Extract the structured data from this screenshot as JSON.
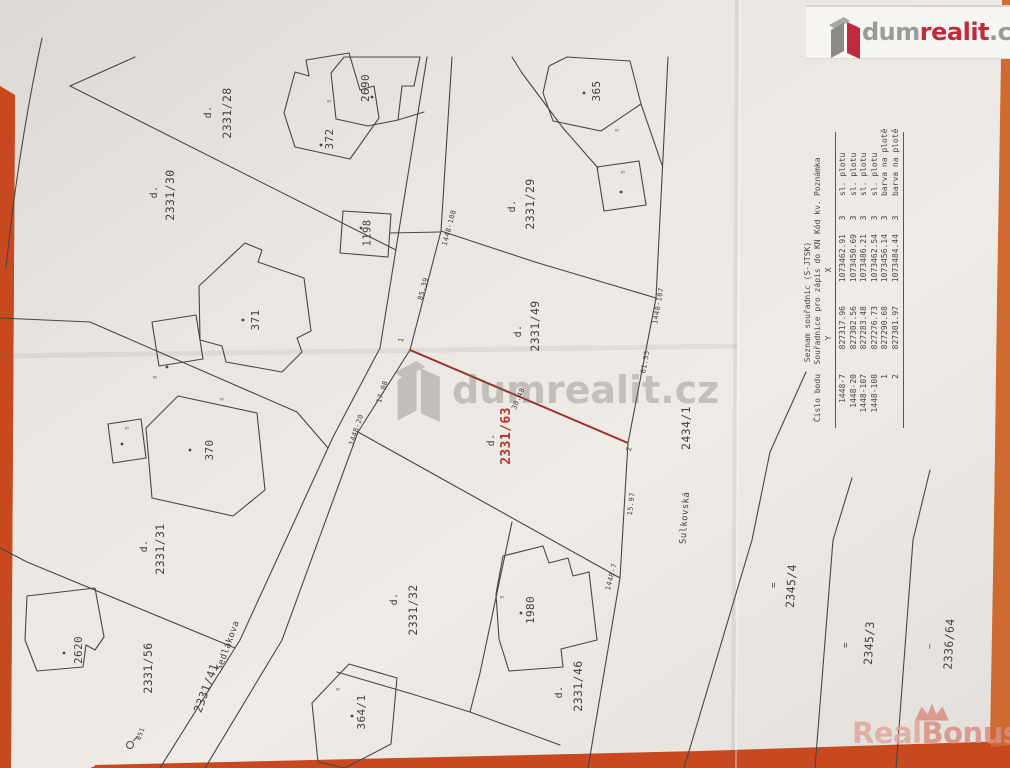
{
  "branding": {
    "logo": {
      "icon": "dumrealit-cube-icon",
      "text_dum": "dum",
      "text_realit": "realit",
      "text_cz": ".cz"
    },
    "watermark_center": {
      "icon": "dumrealit-cube-icon",
      "text": "dumrealit.cz"
    },
    "watermark_bottom": {
      "icon": "crown-icon",
      "text_real": "Real",
      "text_bonus": "Bonus",
      "text_cz": ".cz"
    }
  },
  "colors": {
    "background_red": "#c44a20",
    "paper": "#e9e5e1",
    "ink": "#4a463f",
    "highlight_red": "#9c312a",
    "parcel_red": "#b8352b",
    "tick_gray": "#6b665f",
    "logo_red": "#bf2b3c",
    "logo_gray": "#9a9a9a",
    "watermark_gray": "#8a8580",
    "bonus_pink": "#dc9c92"
  },
  "table": {
    "title": "Seznam souřadnic (S-JTSK)",
    "subtitle": "Souřadnice pro zápis do KN",
    "columns": [
      "Číslo bodu",
      "Y",
      "X",
      "Kód kv.",
      "Poznámka"
    ],
    "rows": [
      [
        "1448-7",
        "827317.96",
        "1073462.91",
        "3",
        "sl. plotu"
      ],
      [
        "1448-20",
        "827302.56",
        "1073450.69",
        "3",
        "sl. plotu"
      ],
      [
        "1448-107",
        "827283.48",
        "1073486.21",
        "3",
        "sl. plotu"
      ],
      [
        "1448-108",
        "827276.73",
        "1073462.54",
        "3",
        "sl. plotu"
      ],
      [
        "1",
        "827290.68",
        "1073456.14",
        "3",
        "barva na plotě"
      ],
      [
        "2",
        "827301.97",
        "1073484.44",
        "3",
        "barva na plotě"
      ]
    ]
  },
  "map": {
    "labels": [
      {
        "t": "d.",
        "x": 209,
        "y": 112,
        "s": 10
      },
      {
        "t": "2331/28",
        "x": 227,
        "y": 113
      },
      {
        "t": "d.",
        "x": 155,
        "y": 192,
        "s": 10
      },
      {
        "t": "2331/30",
        "x": 170,
        "y": 195
      },
      {
        "t": "d.",
        "x": 513,
        "y": 206,
        "s": 10
      },
      {
        "t": "2331/29",
        "x": 530,
        "y": 204
      },
      {
        "t": "d.",
        "x": 519,
        "y": 331,
        "s": 10
      },
      {
        "t": "2331/49",
        "x": 535,
        "y": 326
      },
      {
        "t": "d.",
        "x": 492,
        "y": 440,
        "s": 10
      },
      {
        "t": "2331/63",
        "x": 507,
        "y": 436,
        "s": 13,
        "c": "parcel_red",
        "b": true
      },
      {
        "t": "d.",
        "x": 145,
        "y": 546,
        "s": 10
      },
      {
        "t": "2331/31",
        "x": 160,
        "y": 549
      },
      {
        "t": "2331/56",
        "x": 148,
        "y": 668
      },
      {
        "t": "2331/41",
        "x": 206,
        "y": 688,
        "r": -70
      },
      {
        "t": "Sedlákova",
        "x": 229,
        "y": 646,
        "r": -70,
        "s": 9,
        "n": "street-name-label"
      },
      {
        "t": "d.",
        "x": 395,
        "y": 599,
        "s": 10
      },
      {
        "t": "2331/32",
        "x": 413,
        "y": 610
      },
      {
        "t": "d.",
        "x": 560,
        "y": 692,
        "s": 10
      },
      {
        "t": "2331/46",
        "x": 578,
        "y": 686
      },
      {
        "t": "2434/1",
        "x": 686,
        "y": 428
      },
      {
        "t": "Sulkovská",
        "x": 686,
        "y": 518,
        "r": -86,
        "s": 9,
        "n": "street-name-label"
      },
      {
        "t": "2345/4",
        "x": 791,
        "y": 586,
        "r": -87
      },
      {
        "t": "=",
        "x": 775,
        "y": 585,
        "r": -87,
        "s": 9
      },
      {
        "t": "2345/3",
        "x": 869,
        "y": 643,
        "r": -87
      },
      {
        "t": "=",
        "x": 847,
        "y": 645,
        "r": -87,
        "s": 9
      },
      {
        "t": "2336/64",
        "x": 949,
        "y": 644,
        "r": -87
      },
      {
        "t": "—",
        "x": 931,
        "y": 646,
        "r": -87,
        "s": 9
      },
      {
        "t": "2690",
        "x": 366,
        "y": 88,
        "s": 11,
        "n": "building-number-label"
      },
      {
        "t": "372",
        "x": 330,
        "y": 139,
        "s": 11,
        "n": "building-number-label"
      },
      {
        "t": "1198",
        "x": 368,
        "y": 233,
        "s": 10.5,
        "n": "building-number-label"
      },
      {
        "t": "371",
        "x": 256,
        "y": 320,
        "s": 11,
        "n": "building-number-label"
      },
      {
        "t": "370",
        "x": 210,
        "y": 450,
        "s": 11,
        "n": "building-number-label"
      },
      {
        "t": "2620",
        "x": 79,
        "y": 650,
        "s": 11,
        "n": "building-number-label"
      },
      {
        "t": "364/1",
        "x": 362,
        "y": 712,
        "s": 11,
        "n": "building-number-label"
      },
      {
        "t": "1980",
        "x": 531,
        "y": 610,
        "s": 11,
        "n": "building-number-label"
      },
      {
        "t": "365",
        "x": 597,
        "y": 91,
        "s": 11,
        "n": "building-number-label"
      },
      {
        "t": "1448-108",
        "x": 450,
        "y": 228,
        "s": 7,
        "r": -75,
        "n": "survey-point-label"
      },
      {
        "t": "85.39",
        "x": 424,
        "y": 289,
        "s": 7,
        "r": -75,
        "n": "measurement-label"
      },
      {
        "t": "1",
        "x": 402,
        "y": 340,
        "s": 7,
        "r": -75,
        "n": "survey-point-label"
      },
      {
        "t": "17.08",
        "x": 383,
        "y": 392,
        "s": 7,
        "r": -72,
        "n": "measurement-label"
      },
      {
        "t": "1448-20",
        "x": 357,
        "y": 430,
        "s": 7,
        "r": -72,
        "n": "survey-point-label"
      },
      {
        "t": "30.48",
        "x": 519,
        "y": 399,
        "s": 7,
        "r": -67,
        "n": "measurement-label"
      },
      {
        "t": "2",
        "x": 630,
        "y": 449,
        "s": 7,
        "r": -80,
        "n": "survey-point-label"
      },
      {
        "t": "1448-107",
        "x": 659,
        "y": 306,
        "s": 7,
        "r": -80,
        "n": "survey-point-label"
      },
      {
        "t": "61.55",
        "x": 646,
        "y": 362,
        "s": 7,
        "r": -80,
        "n": "measurement-label"
      },
      {
        "t": "15.97",
        "x": 632,
        "y": 504,
        "s": 7,
        "r": -83,
        "n": "measurement-label"
      },
      {
        "t": "1448-7",
        "x": 612,
        "y": 577,
        "s": 7,
        "r": -75,
        "n": "survey-point-label"
      },
      {
        "t": "651",
        "x": 141,
        "y": 734,
        "s": 6.5,
        "r": -70,
        "n": "survey-point-label"
      },
      {
        "t": "s",
        "x": 329,
        "y": 101,
        "s": 6.5,
        "c": "tick_gray",
        "n": "map-tick"
      },
      {
        "t": "s",
        "x": 617,
        "y": 130,
        "s": 6.5,
        "c": "tick_gray",
        "n": "map-tick"
      },
      {
        "t": "s",
        "x": 623,
        "y": 172,
        "s": 6.5,
        "c": "tick_gray",
        "n": "map-tick"
      },
      {
        "t": "s",
        "x": 155,
        "y": 377,
        "s": 6.5,
        "c": "tick_gray",
        "n": "map-tick"
      },
      {
        "t": "s",
        "x": 222,
        "y": 399,
        "s": 6.5,
        "c": "tick_gray",
        "n": "map-tick"
      },
      {
        "t": "s",
        "x": 127,
        "y": 428,
        "s": 6.5,
        "c": "tick_gray",
        "n": "map-tick"
      },
      {
        "t": "s",
        "x": 502,
        "y": 597,
        "s": 6.5,
        "c": "tick_gray",
        "n": "map-tick"
      },
      {
        "t": "s",
        "x": 338,
        "y": 689,
        "s": 6.5,
        "c": "tick_gray",
        "n": "map-tick"
      }
    ],
    "building_dots": [
      [
        372,
        97
      ],
      [
        321,
        145
      ],
      [
        361,
        228
      ],
      [
        243,
        320
      ],
      [
        167,
        367
      ],
      [
        190,
        450
      ],
      [
        122,
        444
      ],
      [
        64,
        653
      ],
      [
        352,
        716
      ],
      [
        521,
        613
      ],
      [
        584,
        93
      ],
      [
        621,
        192
      ]
    ]
  }
}
